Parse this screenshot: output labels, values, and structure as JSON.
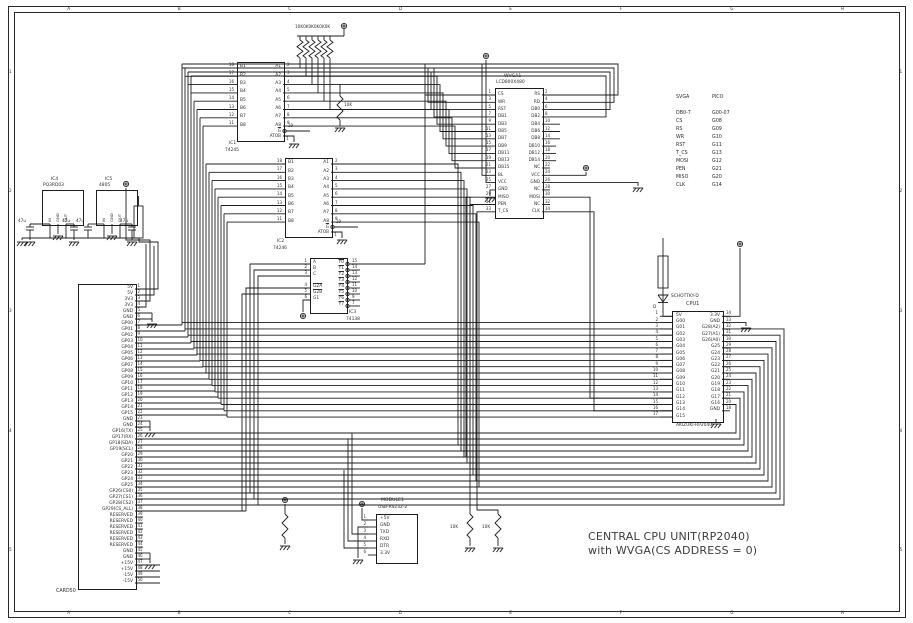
{
  "frame": {
    "columns": [
      "A",
      "B",
      "C",
      "D",
      "E",
      "F",
      "G",
      "H"
    ],
    "rows": [
      "1",
      "2",
      "3",
      "4",
      "5"
    ]
  },
  "title_block": {
    "line1": "CENTRAL CPU UNIT(RP2040)",
    "line2": "with WVGA(CS ADDRESS = 0)"
  },
  "pullups": {
    "label": "10K0K0K0K0K0K"
  },
  "labels": {
    "cap": "47u",
    "res": "10K"
  },
  "diode": {
    "value": "SCHOTTKY-D",
    "ref": "D"
  },
  "reg1": {
    "ref": "IC4",
    "part": "PQ3RD03",
    "pins": [
      "IN",
      "GND",
      "OUT"
    ]
  },
  "reg2": {
    "ref": "IC5",
    "part": "4805",
    "pins": [
      "IN",
      "GND",
      "OUT"
    ]
  },
  "ic1": {
    "ref": "IC1",
    "part": "74245",
    "gate_label": "G",
    "gate_pin": "19",
    "dir_label": "ATOB",
    "dir_pin": "1",
    "left_pins": [
      [
        "18",
        "B1"
      ],
      [
        "17",
        "B2"
      ],
      [
        "16",
        "B3"
      ],
      [
        "15",
        "B4"
      ],
      [
        "14",
        "B5"
      ],
      [
        "13",
        "B6"
      ],
      [
        "12",
        "B7"
      ],
      [
        "11",
        "B8"
      ]
    ],
    "right_pins": [
      [
        "2",
        "A1"
      ],
      [
        "3",
        "A2"
      ],
      [
        "4",
        "A3"
      ],
      [
        "5",
        "A4"
      ],
      [
        "6",
        "A5"
      ],
      [
        "7",
        "A6"
      ],
      [
        "8",
        "A7"
      ],
      [
        "9",
        "A8"
      ]
    ]
  },
  "ic2": {
    "ref": "IC2",
    "part": "74246",
    "gate_label": "G",
    "gate_pin": "19",
    "dir_label": "ATOB",
    "dir_pin": "1",
    "left_pins": [
      [
        "18",
        "B1"
      ],
      [
        "17",
        "B2"
      ],
      [
        "16",
        "B3"
      ],
      [
        "15",
        "B4"
      ],
      [
        "14",
        "B5"
      ],
      [
        "13",
        "B6"
      ],
      [
        "12",
        "B7"
      ],
      [
        "11",
        "B8"
      ]
    ],
    "right_pins": [
      [
        "2",
        "A1"
      ],
      [
        "3",
        "A2"
      ],
      [
        "4",
        "A3"
      ],
      [
        "5",
        "A4"
      ],
      [
        "6",
        "A5"
      ],
      [
        "7",
        "A6"
      ],
      [
        "8",
        "A7"
      ],
      [
        "9",
        "A8"
      ]
    ]
  },
  "ic3": {
    "ref": "IC3",
    "part": "74138",
    "left_pins": [
      [
        "1",
        "A",
        0
      ],
      [
        "2",
        "B",
        0
      ],
      [
        "3",
        "C",
        0
      ],
      [
        "4",
        "G2A",
        1
      ],
      [
        "5",
        "G2B",
        1
      ],
      [
        "6",
        "G1",
        0
      ]
    ],
    "right_pins": [
      [
        "15",
        "Y0"
      ],
      [
        "14",
        "Y1"
      ],
      [
        "13",
        "Y2"
      ],
      [
        "12",
        "Y3"
      ],
      [
        "11",
        "Y4"
      ],
      [
        "10",
        "Y5"
      ],
      [
        "9",
        "Y6"
      ],
      [
        "7",
        "Y7"
      ]
    ]
  },
  "lcd": {
    "ref": "WVGA1",
    "part": "LCD800X480",
    "left_pins": [
      [
        "1",
        "CS"
      ],
      [
        "3",
        "WR"
      ],
      [
        "5",
        "RST"
      ],
      [
        "7",
        "DB1"
      ],
      [
        "9",
        "DB3"
      ],
      [
        "11",
        "DB5"
      ],
      [
        "13",
        "DB7"
      ],
      [
        "15",
        "DB9"
      ],
      [
        "17",
        "DB11"
      ],
      [
        "19",
        "DB13"
      ],
      [
        "21",
        "DB15"
      ],
      [
        "23",
        "BL"
      ],
      [
        "25",
        "VCC"
      ],
      [
        "27",
        "GND"
      ],
      [
        "29",
        "MISO"
      ],
      [
        "31",
        "PEN"
      ],
      [
        "33",
        "T_CS"
      ]
    ],
    "right_pins": [
      [
        "2",
        "RS"
      ],
      [
        "4",
        "RD"
      ],
      [
        "6",
        "DB0"
      ],
      [
        "8",
        "DB2"
      ],
      [
        "10",
        "DB4"
      ],
      [
        "12",
        "DB6"
      ],
      [
        "14",
        "DB8"
      ],
      [
        "16",
        "DB10"
      ],
      [
        "18",
        "DB12"
      ],
      [
        "20",
        "DB14"
      ],
      [
        "22",
        "NC"
      ],
      [
        "24",
        "VCC"
      ],
      [
        "26",
        "GND"
      ],
      [
        "28",
        "NC"
      ],
      [
        "30",
        "MOSI"
      ],
      [
        "32",
        "NC"
      ],
      [
        "34",
        "CLK"
      ]
    ]
  },
  "pico_map": {
    "headers": [
      "SVGA",
      "PICO"
    ],
    "rows": [
      [
        "DB0-7",
        "G00-07"
      ],
      [
        "CS",
        "G08"
      ],
      [
        "RS",
        "G09"
      ],
      [
        "WR",
        "G10"
      ],
      [
        "RST",
        "G11"
      ],
      [
        "T_CS",
        "G13"
      ],
      [
        "MOSI",
        "G12"
      ],
      [
        "PEN",
        "G21"
      ],
      [
        "MISO",
        "G20"
      ],
      [
        "CLK",
        "G14"
      ]
    ]
  },
  "cpu": {
    "ref": "CPU1",
    "part": "AKIZUKI-RP2040",
    "left_pins": [
      [
        "1",
        "5V"
      ],
      [
        "2",
        "G00"
      ],
      [
        "3",
        "G01"
      ],
      [
        "4",
        "G02"
      ],
      [
        "5",
        "G03"
      ],
      [
        "6",
        "G04"
      ],
      [
        "7",
        "G05"
      ],
      [
        "8",
        "G06"
      ],
      [
        "9",
        "G07"
      ],
      [
        "10",
        "G08"
      ],
      [
        "11",
        "G09"
      ],
      [
        "12",
        "G10"
      ],
      [
        "13",
        "G11"
      ],
      [
        "14",
        "G12"
      ],
      [
        "15",
        "G13"
      ],
      [
        "16",
        "G14"
      ],
      [
        "17",
        "G15"
      ]
    ],
    "right_pins": [
      [
        "34",
        "3.3V"
      ],
      [
        "33",
        "GND"
      ],
      [
        "32",
        "G28(A2)"
      ],
      [
        "31",
        "G27(A1)"
      ],
      [
        "30",
        "G26(A0)"
      ],
      [
        "29",
        "G25"
      ],
      [
        "28",
        "G24"
      ],
      [
        "27",
        "G23"
      ],
      [
        "26",
        "G22"
      ],
      [
        "25",
        "G21"
      ],
      [
        "24",
        "G20"
      ],
      [
        "23",
        "G19"
      ],
      [
        "22",
        "G18"
      ],
      [
        "21",
        "G17"
      ],
      [
        "20",
        "G16"
      ],
      [
        "18",
        "GND"
      ]
    ]
  },
  "card": {
    "ref": "CARD50",
    "pins": [
      "5V",
      "5V",
      "3V3",
      "3V3",
      "GND",
      "GND",
      "GP00",
      "GP01",
      "GP02",
      "GP03",
      "GP04",
      "GP05",
      "GP06",
      "GP07",
      "GP08",
      "GP09",
      "GP10",
      "GP11",
      "GP12",
      "GP13",
      "GP14",
      "GP15",
      "GND",
      "GND",
      "GP16(TX)",
      "GP17(RX)",
      "GP18(SDA)",
      "GP19(SCL)",
      "GP20",
      "GP21",
      "GP22",
      "GP23",
      "GP24",
      "GP25",
      "GP26(CS0)",
      "GP27(CS1)",
      "GP28(CS2)",
      "GP29(CS_ALL)",
      "RESERVED",
      "RESERVED",
      "RESERVED",
      "RESERVED",
      "RESERVED",
      "RESERVED",
      "GND",
      "GND",
      "+15V",
      "+15V",
      "-15V",
      "-15V"
    ]
  },
  "module": {
    "ref": "MODULE1",
    "part": "USB-RS232-2",
    "pins": [
      [
        "1",
        "+5V"
      ],
      [
        "2",
        "GND"
      ],
      [
        "3",
        "TXD"
      ],
      [
        "4",
        "RXD"
      ],
      [
        "5",
        "DTR"
      ],
      [
        "6",
        "3.3V"
      ]
    ]
  },
  "colors": {
    "line": "#1d1d1d",
    "text": "#2e2e2e",
    "bg": "#ffffff"
  }
}
